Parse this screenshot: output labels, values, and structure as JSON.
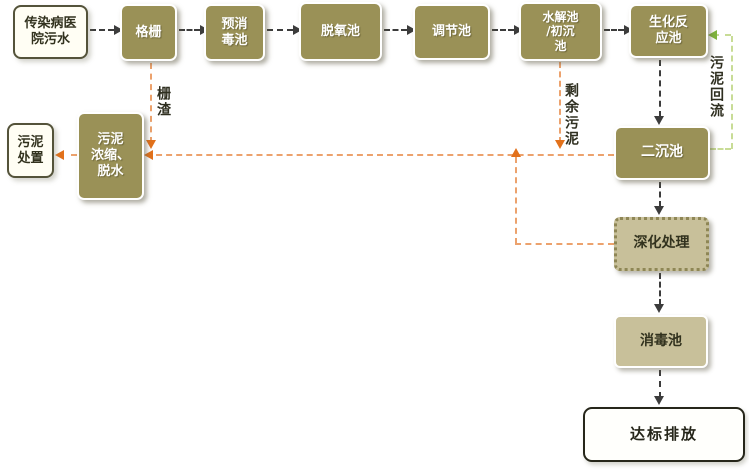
{
  "diagram": {
    "nodes": {
      "hospital": {
        "label": "传染病医\n院污水"
      },
      "grille": {
        "label": "格栅"
      },
      "pre": {
        "label": "预消\n毒池"
      },
      "deox": {
        "label": "脱氧池"
      },
      "reg": {
        "label": "调节池"
      },
      "hydro": {
        "label": "水解池\n/初沉\n池"
      },
      "bio": {
        "label": "生化反\n应池"
      },
      "disposal": {
        "label": "污泥\n处置"
      },
      "thicken": {
        "label": "污泥\n浓缩、\n脱水"
      },
      "second": {
        "label": "二沉池"
      },
      "advanced": {
        "label": "深化处理"
      },
      "disinf": {
        "label": "消毒池"
      },
      "discharge": {
        "label": "达标排放"
      }
    },
    "edge_labels": {
      "screen_residue": "栅渣",
      "excess_sludge": "剩余污泥",
      "sludge_return": "污泥回流"
    },
    "colors": {
      "olive_box": "#9A9157",
      "tan_box": "#C8C09A",
      "white_box": "#FFFEF4",
      "dark_border": "#54533A",
      "black_arrow": "#3C3C3C",
      "orange_line": "#ECA26D",
      "orange_arrow": "#E2711B",
      "green_line": "#C8DC96",
      "green_arrow": "#7FB43C"
    }
  }
}
